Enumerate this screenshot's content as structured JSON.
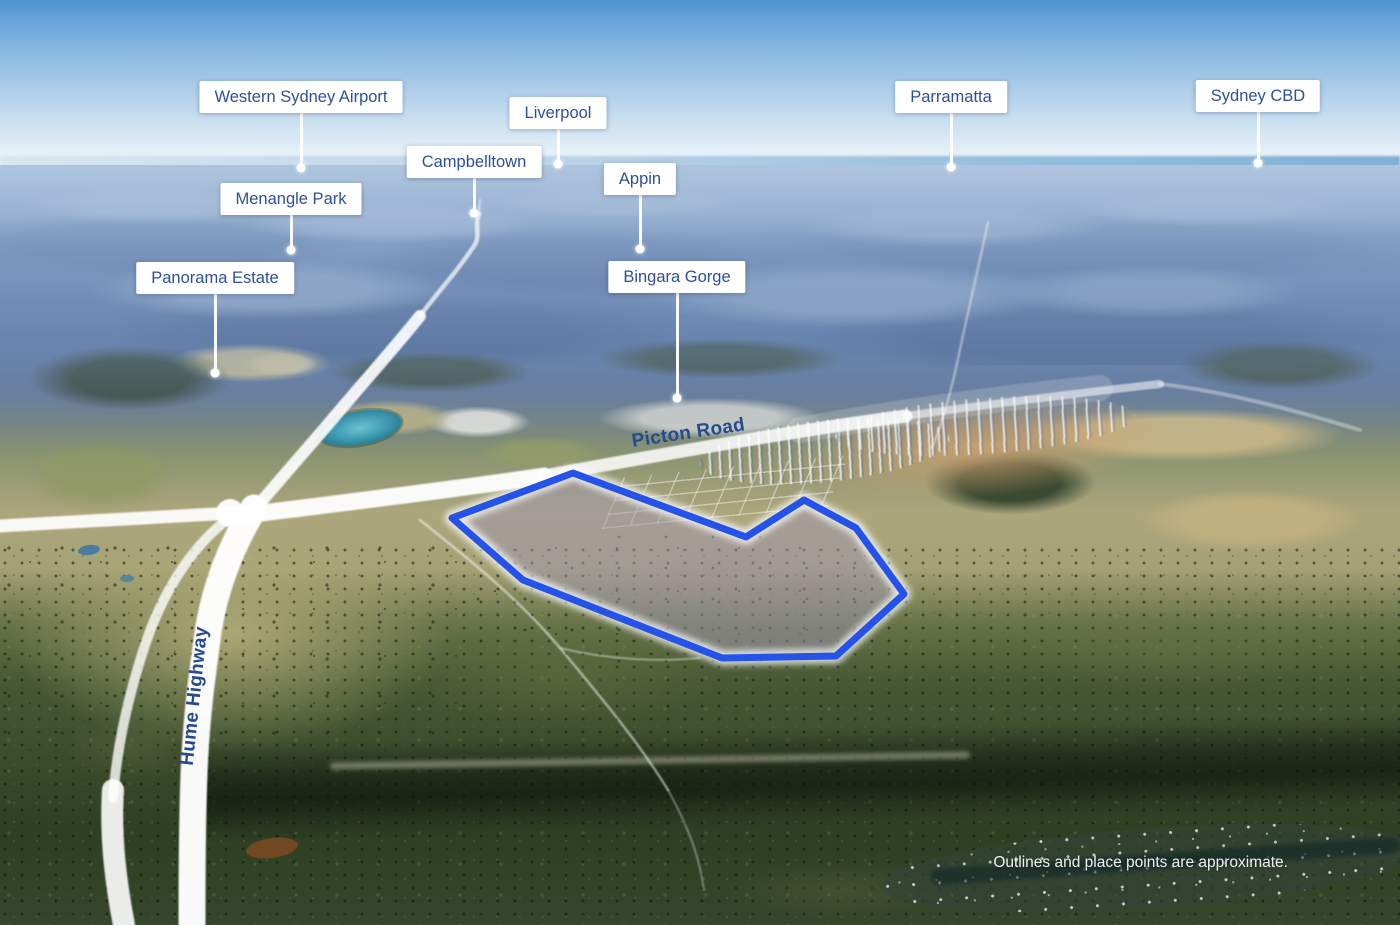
{
  "image_type": "aerial-location-map",
  "disclaimer": "Outlines and place points are approximate.",
  "place_labels": [
    {
      "id": "western-sydney-airport",
      "text": "Western Sydney Airport"
    },
    {
      "id": "liverpool",
      "text": "Liverpool"
    },
    {
      "id": "campbelltown",
      "text": "Campbelltown"
    },
    {
      "id": "menangle-park",
      "text": "Menangle Park"
    },
    {
      "id": "appin",
      "text": "Appin"
    },
    {
      "id": "panorama-estate",
      "text": "Panorama Estate"
    },
    {
      "id": "bingara-gorge",
      "text": "Bingara Gorge"
    },
    {
      "id": "parramatta",
      "text": "Parramatta"
    },
    {
      "id": "sydney-cbd",
      "text": "Sydney CBD"
    }
  ],
  "road_labels": [
    {
      "id": "picton-road",
      "text": "Picton Road"
    },
    {
      "id": "hume-highway",
      "text": "Hume Highway"
    }
  ],
  "site_outline": {
    "name": "Highlighted land parcel",
    "stroke_color": "#2552e8",
    "fill_color": "rgba(158,150,176,0.5)"
  },
  "style_colors": {
    "label_text": "#2d4f9a",
    "road_label_text": "#27498e",
    "leader": "#ffffff"
  }
}
